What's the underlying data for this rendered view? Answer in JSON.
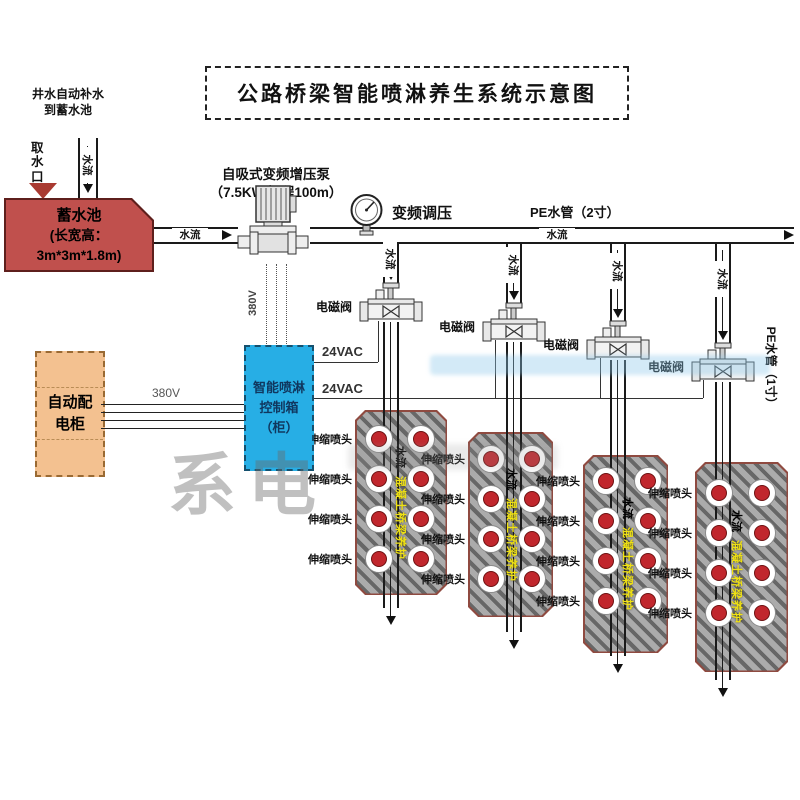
{
  "title": "公路桥梁智能喷淋养生系统示意图",
  "top_left_note": {
    "line1": "井水自动补水",
    "line2": "到蓄水池"
  },
  "intake_label": "取水口",
  "reservoir": {
    "line1": "蓄水池",
    "line2": "(长宽高：",
    "line3": "3m*3m*1.8m)"
  },
  "pump_label": {
    "line1": "自吸式变频增压泵",
    "line2": "（7.5KW,扬程100m）"
  },
  "gauge_label": "变频调压",
  "pipes": {
    "main_label": "PE水管（2寸）",
    "branch_pipe_label": "PE水管（1寸）",
    "flow": "水流"
  },
  "power": {
    "v380": "380V",
    "v24": "24VAC"
  },
  "distribution_cabinet": {
    "line1": "自动配",
    "line2": "电柜"
  },
  "control_box": {
    "line1": "智能喷淋",
    "line2": "控制箱",
    "line3": "（柜）"
  },
  "branches": [
    {
      "valve_label": "电磁阀",
      "flow_label": "水流"
    },
    {
      "valve_label": "电磁阀",
      "flow_label": "水流"
    },
    {
      "valve_label": "电磁阀",
      "flow_label": "水流"
    },
    {
      "valve_label": "电磁阀",
      "flow_label": "水流"
    }
  ],
  "blocks": [
    {
      "flow_label": "水流",
      "girder_label": "混凝土桥梁养护",
      "spray_head_label": "伸缩喷头",
      "spray_head_count": 8
    },
    {
      "flow_label": "水流",
      "girder_label": "混凝土桥梁养护",
      "spray_head_label": "伸缩喷头",
      "spray_head_count": 8
    },
    {
      "flow_label": "水流",
      "girder_label": "混凝土桥梁养护",
      "spray_head_label": "伸缩喷头",
      "spray_head_count": 8
    },
    {
      "flow_label": "水流",
      "girder_label": "混凝土桥梁养护",
      "spray_head_label": "伸缩喷头",
      "spray_head_count": 8
    }
  ],
  "watermark": "系电",
  "colors": {
    "reservoir": "#c0504d",
    "control_box": "#27aee5",
    "cabinet": "#f3c190",
    "spray_head": "#c1272d",
    "girder_text": "#f0e213",
    "line": "#1a1a1a"
  }
}
